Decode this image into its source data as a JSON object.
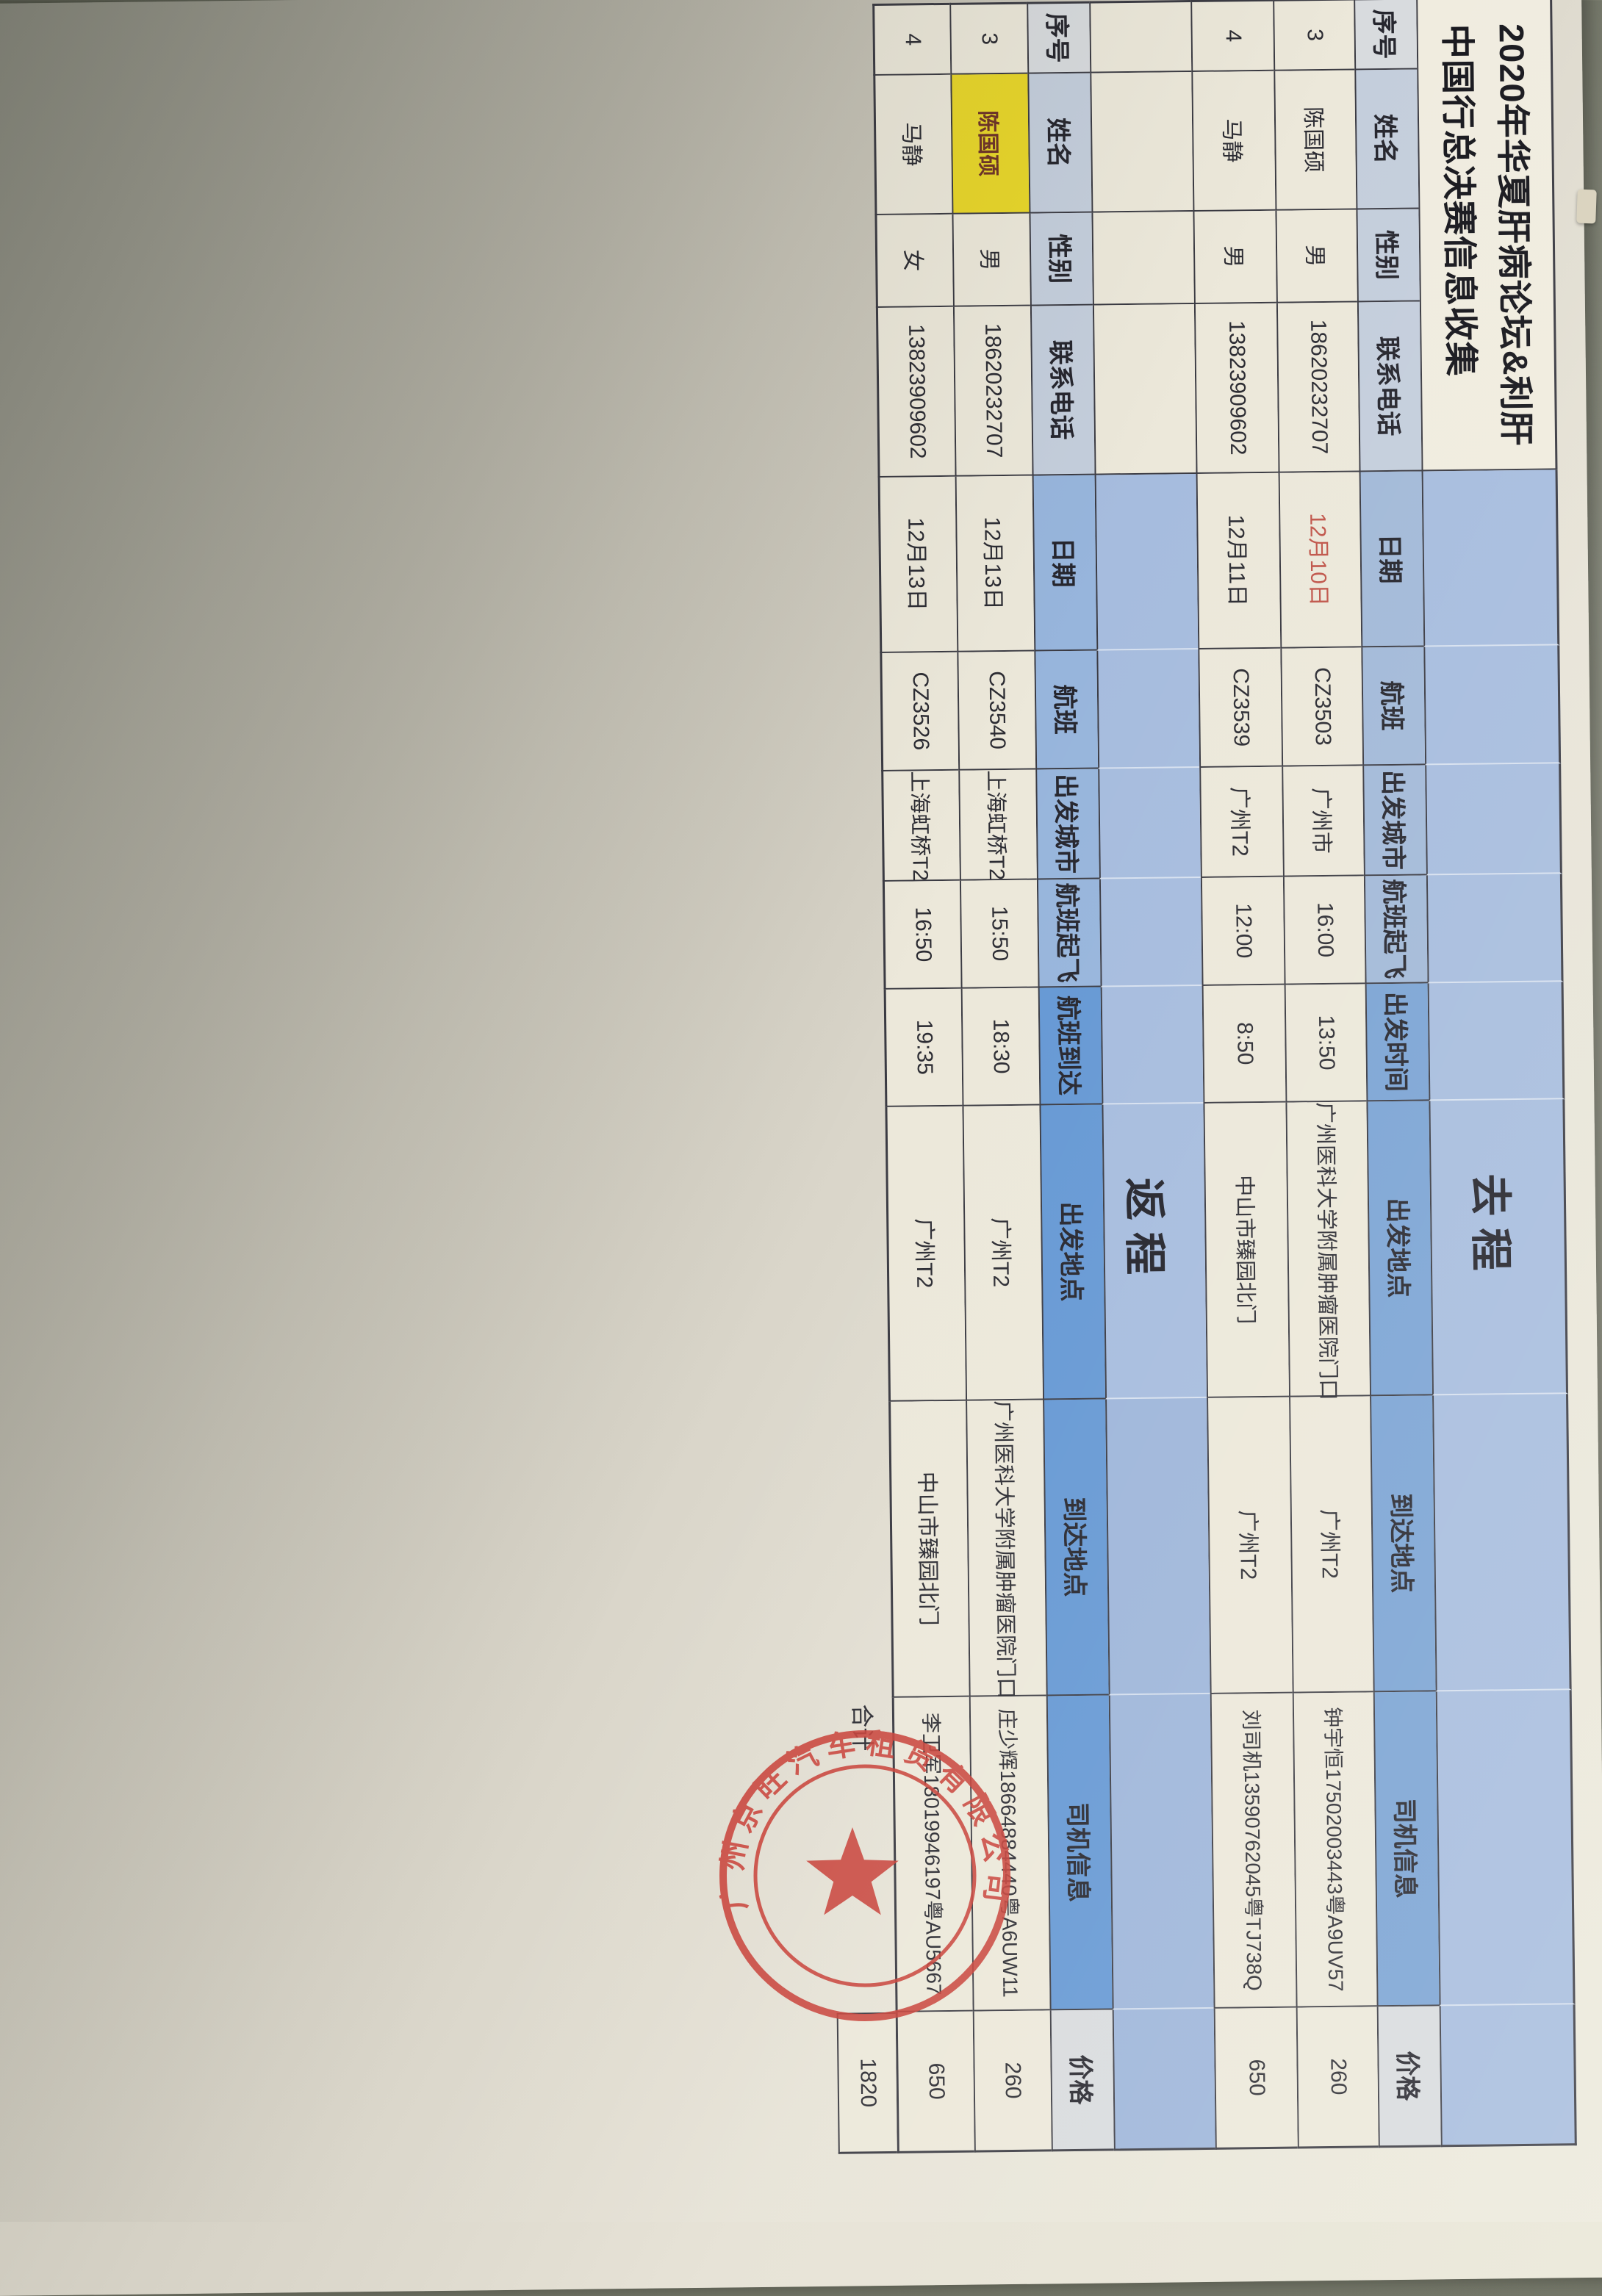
{
  "document": {
    "title_line1": "2020年华夏肝病论坛&利肝",
    "title_line2": "中国行总决赛信息收集",
    "section_outbound": "去程",
    "section_return": "返程",
    "headers": {
      "num": "序号",
      "name": "姓名",
      "gender": "性别",
      "phone": "联系电话",
      "date": "日期",
      "flight": "航班",
      "city": "出发城市",
      "takeoff": "航班起飞",
      "depart_time": "出发时间",
      "arrive_time": "航班到达",
      "from": "出发地点",
      "to": "到达地点",
      "driver": "司机信息",
      "price": "价格"
    },
    "outbound_rows": [
      {
        "num": "3",
        "name": "陈国硕",
        "gender": "男",
        "phone": "18620232707",
        "date": "12月10日",
        "flight": "CZ3503",
        "city": "广州市",
        "takeoff": "16:00",
        "time": "13:50",
        "from": "广州医科大学附属肿瘤医院门口",
        "to": "广州T2",
        "driver": "钟宇恒17502003443粤A9UV57",
        "price": "260"
      },
      {
        "num": "4",
        "name": "马静",
        "gender": "男",
        "phone": "13823909602",
        "date": "12月11日",
        "flight": "CZ3539",
        "city": "广州T2",
        "takeoff": "12:00",
        "time": "8:50",
        "from": "中山市臻园北门",
        "to": "广州T2",
        "driver": "刘司机13590762045粤TJ738Q",
        "price": "650"
      }
    ],
    "return_rows": [
      {
        "num": "3",
        "name": "陈国硕",
        "gender": "男",
        "phone": "18620232707",
        "date": "12月13日",
        "flight": "CZ3540",
        "city": "上海虹桥T2",
        "takeoff": "15:50",
        "time": "18:30",
        "from": "广州T2",
        "to": "广州医科大学附属肿瘤医院门口",
        "driver": "庄少辉18664884440粤A6UW11",
        "price": "260"
      },
      {
        "num": "4",
        "name": "马静",
        "gender": "女",
        "phone": "13823909602",
        "date": "12月13日",
        "flight": "CZ3526",
        "city": "上海虹桥T2",
        "takeoff": "16:50",
        "time": "19:35",
        "from": "广州T2",
        "to": "中山市臻园北门",
        "driver": "李卫军18019946197粤AU5667",
        "price": "650"
      }
    ],
    "total_label": "合计",
    "total_value": "1820"
  },
  "stamp": {
    "company": "广州京旺汽车租赁有限公司",
    "color": "#c84038"
  },
  "colors": {
    "header_blue": "#a2b9d8",
    "header_dark_blue": "#7aa3d4",
    "header_gray_blue": "#c4cedc",
    "empty_band_blue": "#a6bcde",
    "highlight_yellow": "#e8d62a",
    "date_red": "#c0564b",
    "paper": "#eceadc",
    "desk": "#82857 7"
  }
}
